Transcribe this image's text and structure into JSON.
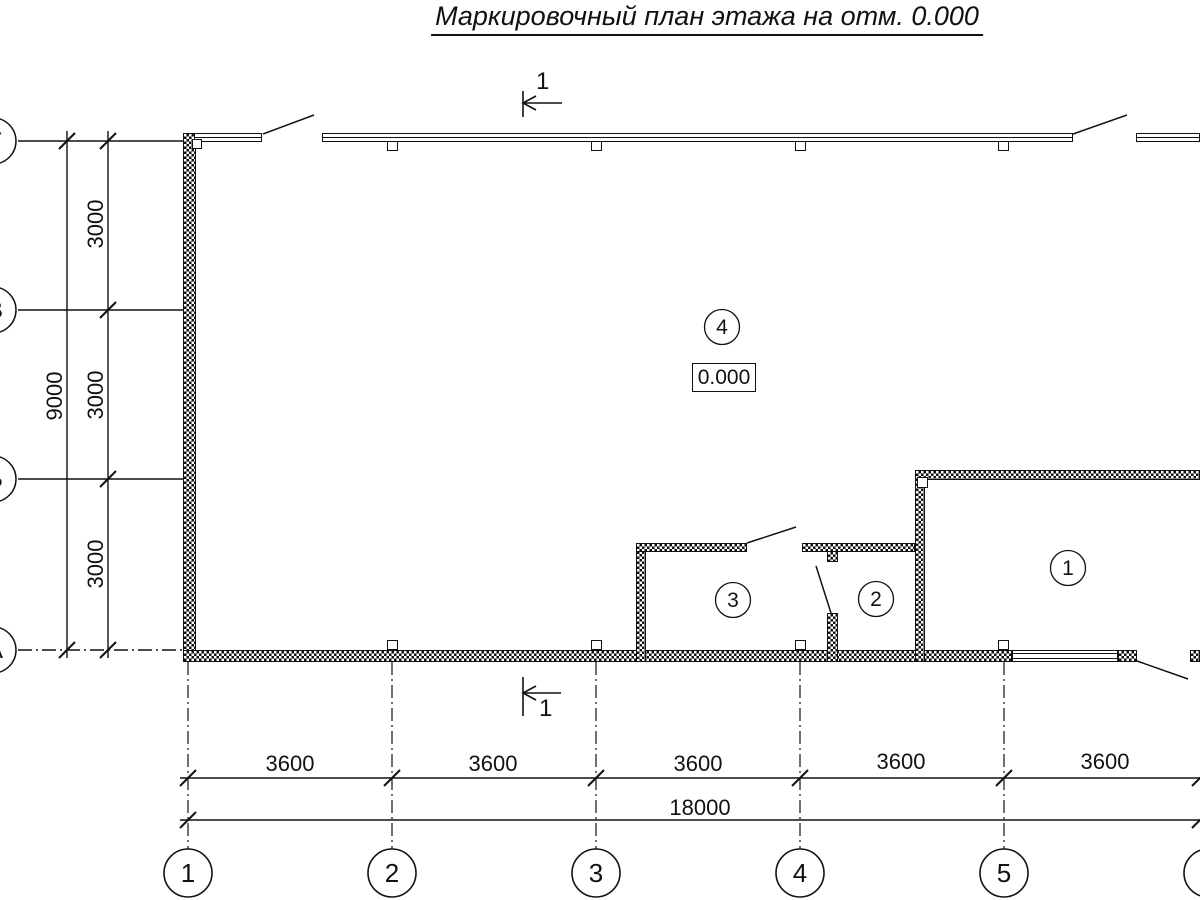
{
  "title": "Маркировочный план этажа на отм. 0.000",
  "section": {
    "top_label": "1",
    "bottom_label": "1"
  },
  "elevation": {
    "value": "0.000"
  },
  "rooms": {
    "room1": "1",
    "room2": "2",
    "room3": "3",
    "room4": "4"
  },
  "axes_bottom": {
    "a1": "1",
    "a2": "2",
    "a3": "3",
    "a4": "4",
    "a5": "5"
  },
  "axes_left": {
    "row_g": "Г",
    "row_v": "В",
    "row_b": "Б",
    "row_a": "А"
  },
  "dimensions": {
    "bottom_segments": [
      "3600",
      "3600",
      "3600",
      "3600",
      "3600"
    ],
    "bottom_total": "18000",
    "left_segments": [
      "3000",
      "3000",
      "3000"
    ],
    "left_total": "9000"
  },
  "colors": {
    "ink": "#111111",
    "background": "#ffffff"
  }
}
